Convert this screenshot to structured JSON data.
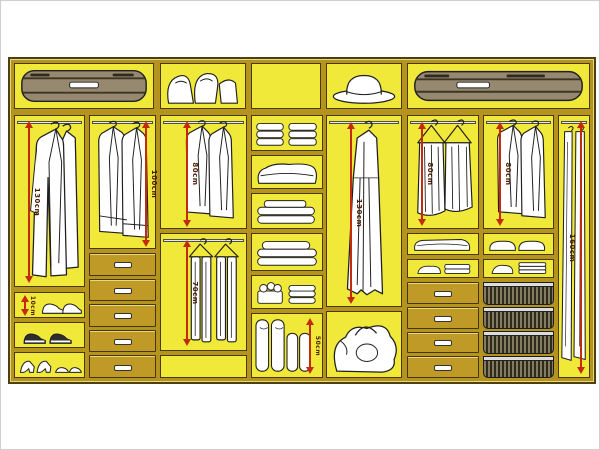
{
  "diagram": {
    "type": "wardrobe-interior-organization",
    "colors": {
      "frame": "#b5931f",
      "frame_outline": "#50400a",
      "cubby_fill": "#f1e93a",
      "drawer_fill": "#c09a26",
      "arrow_red": "#c22b0e",
      "label_text": "#4a1a00",
      "item_fill": "#ffffff",
      "item_outline": "#1f1f1f",
      "background": "#ffffff"
    },
    "measurements": {
      "coat_section": "130cm",
      "shoe_shelf": "10cm",
      "jacket_section": "100cm",
      "shirt_section": "80cm",
      "trouser_section": "70cm",
      "roll_section": "50cm",
      "dress_section": "130cm",
      "folded_trouser_section": "80cm",
      "jumper_section": "80cm",
      "long_garment_section": "160cm"
    },
    "sections": [
      {
        "id": "top-1",
        "content": "suitcase"
      },
      {
        "id": "top-2",
        "content": "soft bags"
      },
      {
        "id": "top-3",
        "content": "empty"
      },
      {
        "id": "top-4",
        "content": "hat"
      },
      {
        "id": "top-5",
        "content": "long suitcase"
      },
      {
        "id": "coat-hang",
        "content": "long coats",
        "measurement": "130cm"
      },
      {
        "id": "shoe-shelf-1",
        "content": "trainers",
        "measurement": "10cm"
      },
      {
        "id": "shoe-shelf-2",
        "content": "shoes"
      },
      {
        "id": "shoe-shelf-3",
        "content": "high heels"
      },
      {
        "id": "jacket-hang",
        "content": "jackets",
        "measurement": "100cm"
      },
      {
        "id": "drawers-left",
        "content": "five drawers"
      },
      {
        "id": "shirt-hang",
        "content": "shirts",
        "measurement": "80cm"
      },
      {
        "id": "trouser-hang",
        "content": "hanging trousers",
        "measurement": "70cm"
      },
      {
        "id": "linen-shelves",
        "content": "folded linens and towels"
      },
      {
        "id": "roll-storage",
        "content": "rolled bedding",
        "measurement": "50cm"
      },
      {
        "id": "dress-hang",
        "content": "long dress",
        "measurement": "130cm"
      },
      {
        "id": "bag-cubby",
        "content": "large soft bag"
      },
      {
        "id": "folded-trouser-hang",
        "content": "trousers over hangers",
        "measurement": "80cm"
      },
      {
        "id": "drawers-right",
        "content": "four drawers"
      },
      {
        "id": "jumper-hang",
        "content": "jackets on hangers",
        "measurement": "80cm"
      },
      {
        "id": "basket-stack",
        "content": "four wire baskets"
      },
      {
        "id": "long-hang",
        "content": "long garment bags",
        "measurement": "160cm"
      }
    ]
  }
}
